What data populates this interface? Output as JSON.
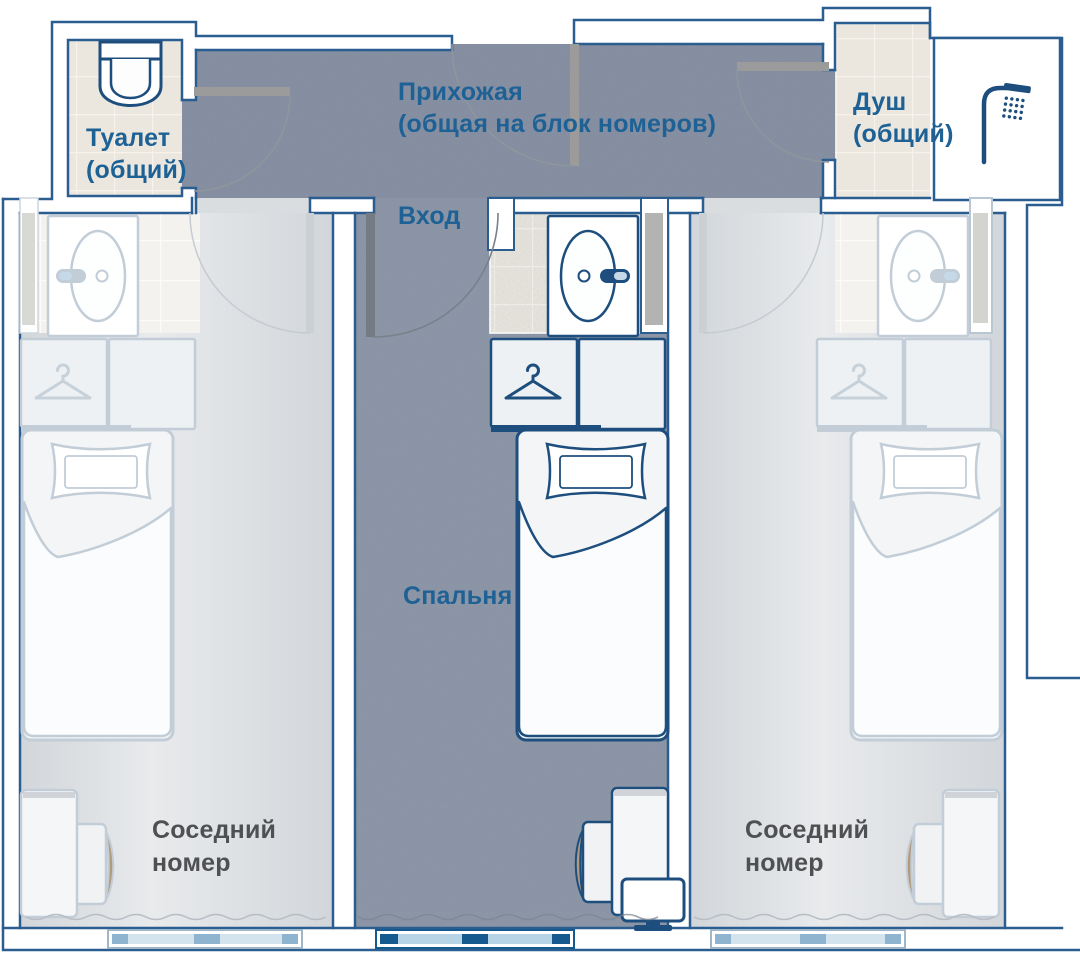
{
  "plan": {
    "hallway": {
      "line1": "Прихожая",
      "line2": "(общая на блок номеров)"
    },
    "entrance_label": "Вход",
    "toilet": {
      "line1": "Туалет",
      "line2": "(общий)"
    },
    "shower": {
      "line1": "Душ",
      "line2": "(общий)"
    },
    "bedroom_label": "Спальня",
    "neighbor_left": {
      "line1": "Соседний",
      "line2": "номер"
    },
    "neighbor_right": {
      "line1": "Соседний",
      "line2": "номер"
    }
  },
  "watermark": {
    "brand": "ClubMed",
    "icon": "Ψ",
    "text": "на Вернадского - actravel.ru"
  },
  "colors": {
    "label_blue": "#1e6195",
    "label_gray": "#4e5052",
    "wall_outline": "#2a5d90",
    "fixture_outline": "#1d4e7d",
    "faded_outline": "#c2cdd7",
    "floor_dark": "#8c96a7",
    "floor_light": "#dadde0",
    "tile_beige": "#ebe7df",
    "window_glass": "#b7d4e6",
    "window_frame": "#155a8e",
    "chair_tan": "#b49a7c",
    "door_leaf_gray": "#9b9b9b"
  },
  "icons": [
    "toilet-icon",
    "shower-head-icon",
    "sink-icon",
    "hanger-icon",
    "bed",
    "wardrobe",
    "desk",
    "chair",
    "monitor",
    "window",
    "door-swing-arc"
  ]
}
